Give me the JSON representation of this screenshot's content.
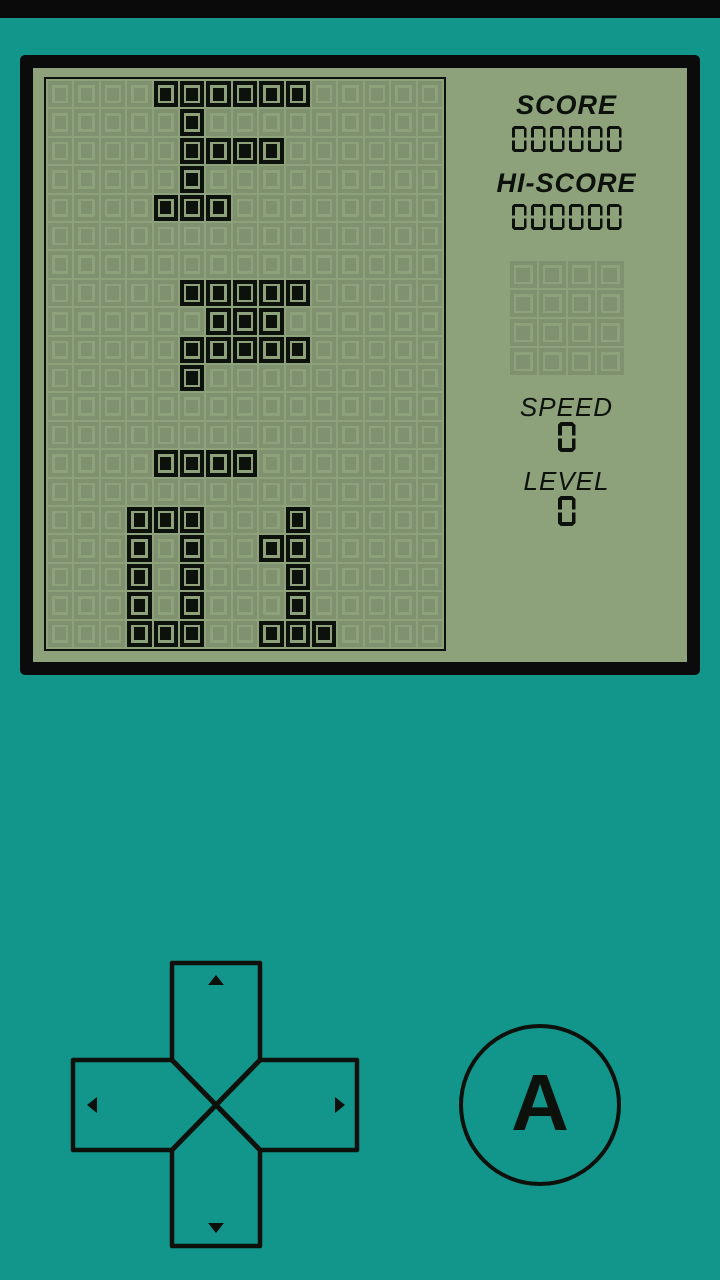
{
  "colors": {
    "teal": "#12968C",
    "ink": "#0D110B",
    "lcd": "#8DA17B",
    "bezel": "#0B0B0B",
    "topbar": "#0A0A0A"
  },
  "lcd": {
    "score_label": "SCORE",
    "score_value": "000000",
    "hiscore_label": "HI-SCORE",
    "hiscore_value": "000000",
    "preview": {
      "rows": 4,
      "cols": 4,
      "cells": [
        "....",
        "....",
        "....",
        "...."
      ]
    },
    "speed_label": "SPEED",
    "speed_value": "0",
    "level_label": "LEVEL",
    "level_value": "0",
    "field": {
      "rows": 20,
      "cols": 15,
      "cells": [
        "....XXXXXX.....",
        ".....X.........",
        ".....XXXX......",
        ".....X.........",
        "....XXX........",
        "...............",
        "...............",
        ".....XXXXX.....",
        "......XXX......",
        ".....XXXXX.....",
        ".....X.........",
        "...............",
        "...............",
        "....XXXX.......",
        "...............",
        "...XXX...X.....",
        "...X.X..XX.....",
        "...X.X...X.....",
        "...X.X...X.....",
        "...XXX..XXX...."
      ]
    }
  },
  "controls": {
    "a_button_label": "A",
    "dpad_buttons": [
      "up",
      "left",
      "right",
      "down"
    ]
  }
}
